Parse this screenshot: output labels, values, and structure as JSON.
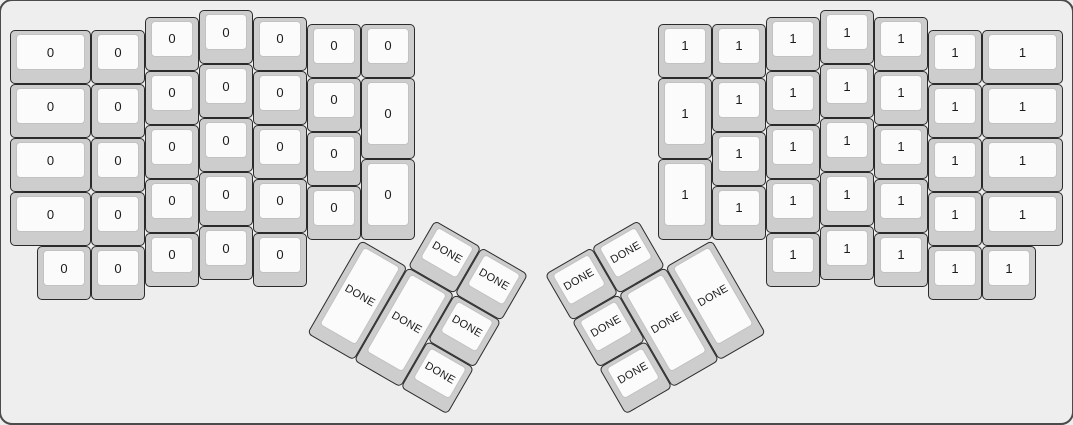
{
  "canvas": {
    "width": 1073,
    "height": 424,
    "background_color": "#eeeeee",
    "frame_border_color": "#4b4b4b"
  },
  "key_style": {
    "cap_color": "#cdcdcd",
    "cap_border_color": "#2b2b2b",
    "top_color": "#fbfbfb",
    "top_border_color": "#c2c2c2",
    "label_color": "#1b1b1b"
  },
  "unit_px": 54,
  "halves": [
    {
      "id": "left-half",
      "name": "keyboard-left-half",
      "label": "0",
      "origin_x": 10,
      "origin_y": 10,
      "keys": [
        [
          0,
          0.375,
          1.5,
          1
        ],
        [
          0,
          1.375,
          1.5,
          1
        ],
        [
          0,
          2.375,
          1.5,
          1
        ],
        [
          0,
          3.375,
          1.5,
          1
        ],
        [
          1.5,
          0.375,
          1,
          1
        ],
        [
          1.5,
          1.375,
          1,
          1
        ],
        [
          1.5,
          2.375,
          1,
          1
        ],
        [
          1.5,
          3.375,
          1,
          1
        ],
        [
          2.5,
          0.125,
          1,
          1
        ],
        [
          2.5,
          1.125,
          1,
          1
        ],
        [
          2.5,
          2.125,
          1,
          1
        ],
        [
          2.5,
          3.125,
          1,
          1
        ],
        [
          3.5,
          0,
          1,
          1
        ],
        [
          3.5,
          1,
          1,
          1
        ],
        [
          3.5,
          2,
          1,
          1
        ],
        [
          3.5,
          3,
          1,
          1
        ],
        [
          4.5,
          0.125,
          1,
          1
        ],
        [
          4.5,
          1.125,
          1,
          1
        ],
        [
          4.5,
          2.125,
          1,
          1
        ],
        [
          4.5,
          3.125,
          1,
          1
        ],
        [
          5.5,
          0.25,
          1,
          1
        ],
        [
          5.5,
          1.25,
          1,
          1
        ],
        [
          5.5,
          2.25,
          1,
          1
        ],
        [
          5.5,
          3.25,
          1,
          1
        ],
        [
          6.5,
          0.25,
          1,
          1
        ],
        [
          6.5,
          1.25,
          1,
          1.5
        ],
        [
          6.5,
          2.75,
          1,
          1.5
        ],
        [
          0.5,
          4.375,
          1,
          1
        ],
        [
          1.5,
          4.375,
          1,
          1
        ],
        [
          2.5,
          4.125,
          1,
          1
        ],
        [
          3.5,
          4,
          1,
          1
        ],
        [
          4.5,
          4.125,
          1,
          1
        ]
      ]
    },
    {
      "id": "right-half",
      "name": "keyboard-right-half",
      "label": "1",
      "origin_x": 658,
      "origin_y": 10,
      "keys": [
        [
          0,
          0.25,
          1,
          1
        ],
        [
          0,
          1.25,
          1,
          1.5
        ],
        [
          0,
          2.75,
          1,
          1.5
        ],
        [
          1,
          0.25,
          1,
          1
        ],
        [
          1,
          1.25,
          1,
          1
        ],
        [
          1,
          2.25,
          1,
          1
        ],
        [
          1,
          3.25,
          1,
          1
        ],
        [
          2,
          0.125,
          1,
          1
        ],
        [
          2,
          1.125,
          1,
          1
        ],
        [
          2,
          2.125,
          1,
          1
        ],
        [
          2,
          3.125,
          1,
          1
        ],
        [
          3,
          0,
          1,
          1
        ],
        [
          3,
          1,
          1,
          1
        ],
        [
          3,
          2,
          1,
          1
        ],
        [
          3,
          3,
          1,
          1
        ],
        [
          4,
          0.125,
          1,
          1
        ],
        [
          4,
          1.125,
          1,
          1
        ],
        [
          4,
          2.125,
          1,
          1
        ],
        [
          4,
          3.125,
          1,
          1
        ],
        [
          5,
          0.375,
          1,
          1
        ],
        [
          5,
          1.375,
          1,
          1
        ],
        [
          5,
          2.375,
          1,
          1
        ],
        [
          5,
          3.375,
          1,
          1
        ],
        [
          6,
          0.375,
          1.5,
          1
        ],
        [
          6,
          1.375,
          1.5,
          1
        ],
        [
          6,
          2.375,
          1.5,
          1
        ],
        [
          6,
          3.375,
          1.5,
          1
        ],
        [
          2,
          4.125,
          1,
          1
        ],
        [
          3,
          4,
          1,
          1
        ],
        [
          4,
          4.125,
          1,
          1
        ],
        [
          5,
          4.375,
          1,
          1
        ],
        [
          6,
          4.375,
          1,
          1
        ]
      ]
    }
  ],
  "thumb_clusters": [
    {
      "id": "left-thumb",
      "name": "left-thumb-cluster",
      "label": "DONE",
      "rotation_deg": 30,
      "center_x": 361,
      "center_y": 239.5,
      "keys": [
        [
          1,
          -1,
          1,
          1
        ],
        [
          2,
          -1,
          1,
          1
        ],
        [
          0,
          0,
          1,
          2
        ],
        [
          1,
          0,
          1,
          2
        ],
        [
          2,
          0,
          1,
          1
        ],
        [
          2,
          1,
          1,
          1
        ]
      ]
    },
    {
      "id": "right-thumb",
      "name": "right-thumb-cluster",
      "label": "DONE",
      "rotation_deg": -30,
      "center_x": 712,
      "center_y": 239.5,
      "keys": [
        [
          -2,
          -1,
          1,
          1
        ],
        [
          -3,
          -1,
          1,
          1
        ],
        [
          -1,
          0,
          1,
          2
        ],
        [
          -2,
          0,
          1,
          2
        ],
        [
          -3,
          0,
          1,
          1
        ],
        [
          -3,
          1,
          1,
          1
        ]
      ]
    }
  ]
}
